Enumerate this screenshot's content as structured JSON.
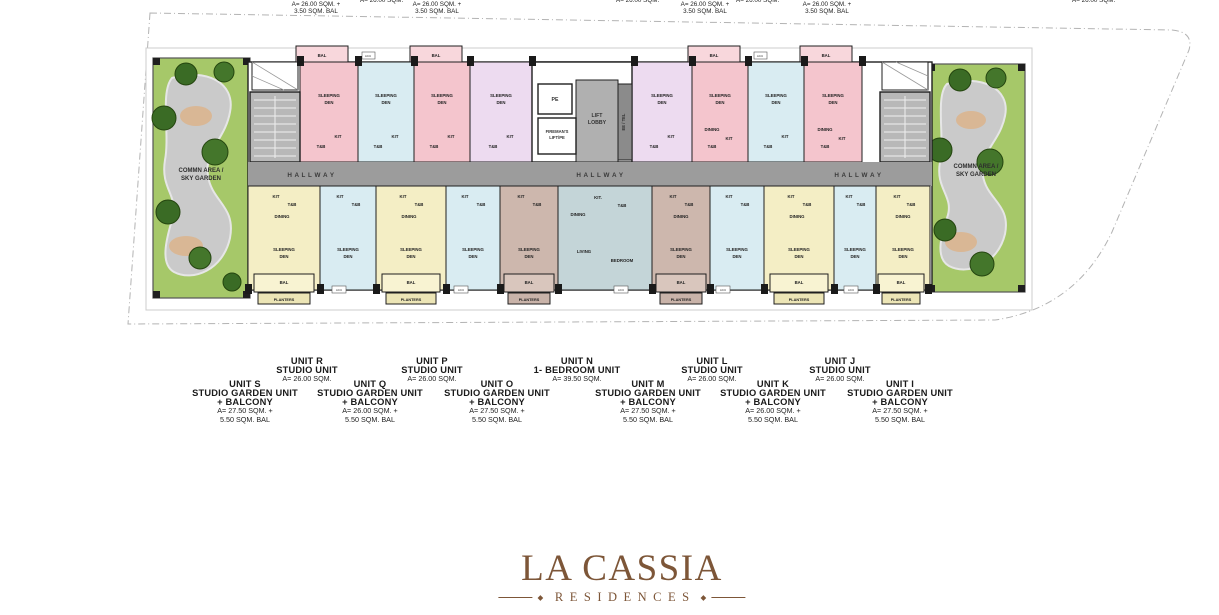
{
  "palette": {
    "unit_pink": "#f4c5cd",
    "unit_blue": "#d9ecf2",
    "unit_lavender": "#eddbf0",
    "unit_cream": "#f4eec5",
    "unit_brown": "#cdb7ad",
    "unit_teal": "#c4d5d8",
    "grass_green": "#a6c869",
    "tree_green": "#3a6b25",
    "hallway_gray": "#9c9c9c",
    "wall_black": "#1f1f1f",
    "logo_brown": "#7d5638"
  },
  "top_cut_labels": {
    "balcony_bold": "+ BALCONY",
    "area_plus": "A= 26.00 SQM. +",
    "bal_area": "3.50 SQM. BAL",
    "area_plain": "A= 26.00 SQM."
  },
  "rooms": {
    "sleeping": "SLEEPING",
    "den": "DEN",
    "dining": "DINING",
    "kit": "KIT",
    "kitdot": "KIT.",
    "tb": "T&B",
    "bal": "BAL",
    "planters": "PLANTERS",
    "acu": "ACU",
    "living": "LIVING",
    "bedroom": "BEDROOM",
    "pe": "PE",
    "fireman1": "FIREMAN'S",
    "fireman2": "LIFT/PE",
    "lift1": "LIFT",
    "lift2": "LOBBY",
    "eetel": "EE / TEL",
    "hallway": "H A L L W A Y",
    "common1": "COMMN AREA /",
    "common2": "SKY GARDEN"
  },
  "legend": {
    "top": [
      {
        "name": "UNIT R",
        "type": "STUDIO UNIT",
        "area": "A= 26.00 SQM."
      },
      {
        "name": "UNIT P",
        "type": "STUDIO UNIT",
        "area": "A= 26.00 SQM."
      },
      {
        "name": "UNIT N",
        "type": "1- BEDROOM UNIT",
        "area": "A= 39.50 SQM."
      },
      {
        "name": "UNIT L",
        "type": "STUDIO UNIT",
        "area": "A= 26.00 SQM."
      },
      {
        "name": "UNIT J",
        "type": "STUDIO UNIT",
        "area": "A= 26.00 SQM."
      }
    ],
    "bottom": [
      {
        "name": "UNIT S",
        "type": "STUDIO GARDEN UNIT",
        "type2": "+ BALCONY",
        "area": "A= 27.50 SQM. +",
        "area2": "5.50 SQM. BAL"
      },
      {
        "name": "UNIT Q",
        "type": "STUDIO GARDEN UNIT",
        "type2": "+ BALCONY",
        "area": "A= 26.00 SQM. +",
        "area2": "5.50 SQM. BAL"
      },
      {
        "name": "UNIT O",
        "type": "STUDIO GARDEN UNIT",
        "type2": "+ BALCONY",
        "area": "A= 27.50 SQM. +",
        "area2": "5.50 SQM. BAL"
      },
      {
        "name": "UNIT M",
        "type": "STUDIO GARDEN UNIT",
        "type2": "+ BALCONY",
        "area": "A= 27.50 SQM. +",
        "area2": "5.50 SQM. BAL"
      },
      {
        "name": "UNIT K",
        "type": "STUDIO GARDEN UNIT",
        "type2": "+ BALCONY",
        "area": "A= 26.00 SQM. +",
        "area2": "5.50 SQM. BAL"
      },
      {
        "name": "UNIT I",
        "type": "STUDIO GARDEN UNIT",
        "type2": "+ BALCONY",
        "area": "A= 27.50 SQM. +",
        "area2": "5.50 SQM. BAL"
      }
    ]
  },
  "logo": {
    "title": "LA CASSIA",
    "subtitle": "RESIDENCES"
  }
}
